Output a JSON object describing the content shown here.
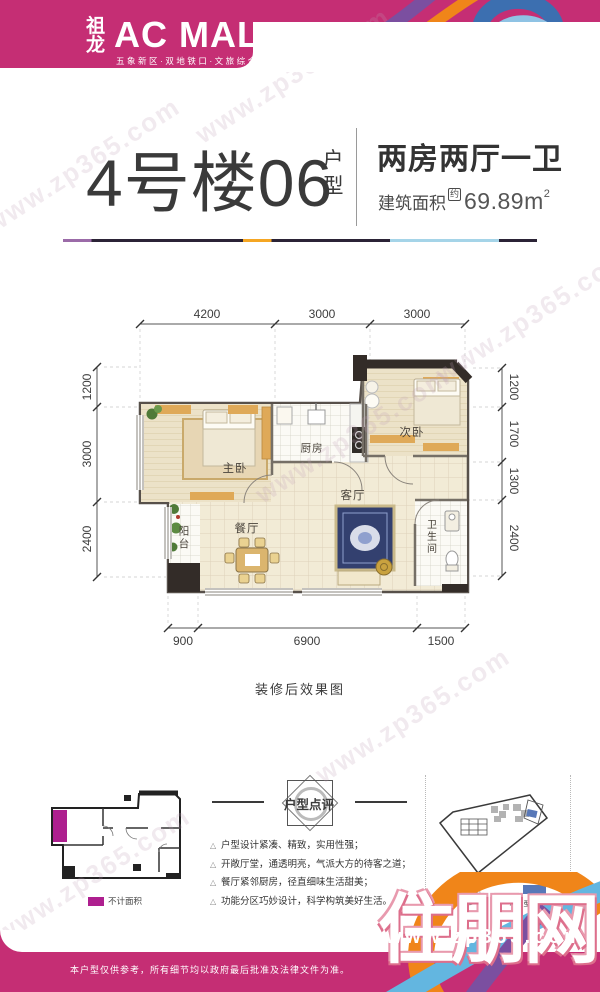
{
  "header": {
    "logo_cn": "祖龙",
    "logo_en": "AC MALL",
    "tagline": "五象新区·双地铁口·文旅综合体"
  },
  "title": {
    "building": "4号楼06",
    "suffix_top": "户",
    "suffix_bottom": "型",
    "layout": "两房两厅一卫",
    "area_label": "建筑面积",
    "area_approx": "约",
    "area_value": "69.89m",
    "area_sup": "2"
  },
  "floorplan": {
    "dims_top": [
      "4200",
      "3000",
      "3000"
    ],
    "dims_left": [
      "1200",
      "3000",
      "2400"
    ],
    "dims_right": [
      "1200",
      "1700",
      "1300",
      "2400"
    ],
    "dims_bottom": [
      "900",
      "6900",
      "1500"
    ],
    "rooms": {
      "master": "主卧",
      "kitchen": "厨房",
      "second": "次卧",
      "living": "客厅",
      "dining": "餐厅",
      "balcony": "阳台",
      "bath": "卫生间"
    },
    "caption": "装修后效果图"
  },
  "mini_plan": {
    "legend": "不计面积"
  },
  "review": {
    "title": "户型点评",
    "points": [
      "户型设计紧凑、精致，实用性强；",
      "开敞厅堂，通透明亮，气派大方的待客之道；",
      "餐厅紧邻厨房，径直细味生活甜美；",
      "功能分区巧妙设计，科学构筑美好生活。"
    ]
  },
  "site_map": {
    "legend": "本户型所在位置"
  },
  "footer": {
    "disclaimer": "本户型仅供参考，所有细节均以政府最后批准及法律文件为准。"
  },
  "watermark": {
    "site_name": "住朋网",
    "url": "www.zp365.com"
  },
  "colors": {
    "brand": "#c52e74",
    "accent_orange": "#f08519",
    "accent_blue": "#5b9bd5",
    "accent_purple": "#7b4fa0",
    "highlight_magenta": "#ae1f8f",
    "map_blue": "#5878b8"
  }
}
